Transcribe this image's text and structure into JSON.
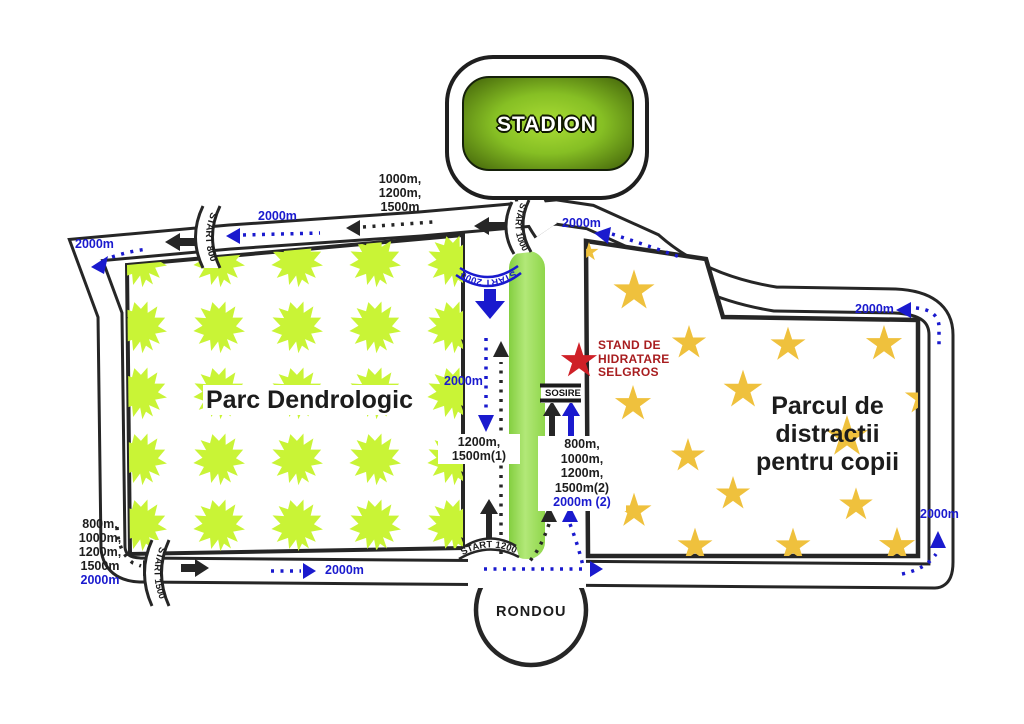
{
  "stadium": {
    "label": "STADION"
  },
  "rondou": {
    "label": "RONDOU"
  },
  "finish": {
    "label": "SOSIRE"
  },
  "parks": {
    "dendrologic": {
      "label": "Parc Dendrologic"
    },
    "distractii": {
      "lines": [
        "Parcul de",
        "distractii",
        "pentru copii"
      ]
    }
  },
  "hydration": {
    "lines": [
      "STAND DE",
      "HIDRATARE",
      "SELGROS"
    ]
  },
  "gates": {
    "start_800": "START 800",
    "start_1000": "START 1000",
    "start_1200": "START 1200",
    "start_1500": "START 1500",
    "start_2000": "START 2000"
  },
  "distance_labels": {
    "top_left_2000": "2000m",
    "top_inner_2000": "2000m",
    "top_group": [
      "1000m,",
      "1200m,",
      "1500m"
    ],
    "stadium_right_2000": "2000m",
    "right_top_2000": "2000m",
    "corridor_2000": "2000m",
    "corridor_group": [
      "1200m,",
      "1500m(1)"
    ],
    "finish_group": [
      "800m,",
      "1000m,",
      "1200m,",
      "1500m(2)"
    ],
    "finish_2000": "2000m (2)",
    "bottom_left_group": [
      "800m,",
      "1000m,",
      "1200m,",
      "1500m"
    ],
    "bottom_left_2000": "2000m",
    "bottom_mid_2000": "2000m",
    "right_bottom_2000": "2000m"
  },
  "colors": {
    "route_blue": "#1a1ace",
    "road_edge": "#262626",
    "leaf_green": "#c9f436",
    "star_gold": "#efc13d",
    "hydration_red": "#a81d1f",
    "star_red": "#cf2027",
    "finish_strip_green": "#9ada52"
  }
}
